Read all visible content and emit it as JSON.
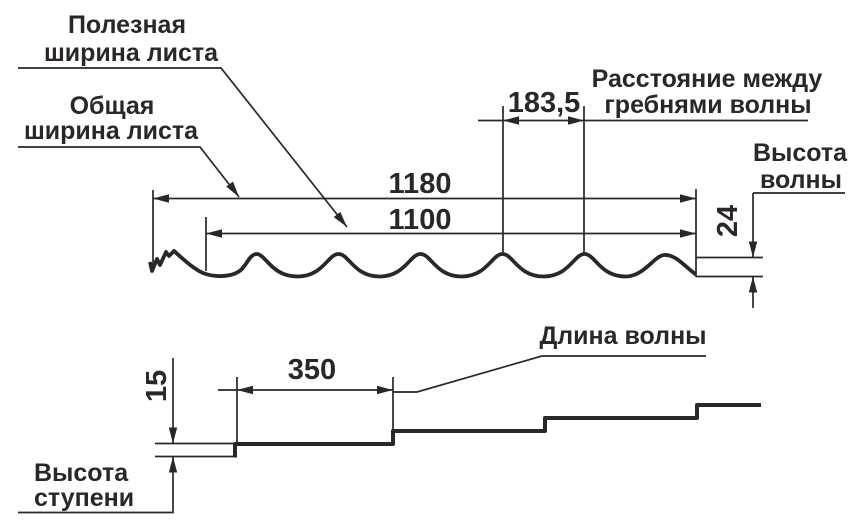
{
  "labels": {
    "useful_width_line1": "Полезная",
    "useful_width_line2": "ширина листа",
    "total_width_line1": "Общая",
    "total_width_line2": "ширина листа",
    "crest_distance_line1": "Расстояние между",
    "crest_distance_line2": "гребнями волны",
    "wave_height_line1": "Высота",
    "wave_height_line2": "волны",
    "wave_length": "Длина волны",
    "step_height_line1": "Высота",
    "step_height_line2": "ступени"
  },
  "dimensions": {
    "total_sheet_width": "1180",
    "useful_sheet_width": "1100",
    "crest_spacing": "183,5",
    "wave_height": "24",
    "wave_length": "350",
    "step_height": "15"
  },
  "colors": {
    "ink": "#2b2627",
    "background": "#ffffff"
  }
}
